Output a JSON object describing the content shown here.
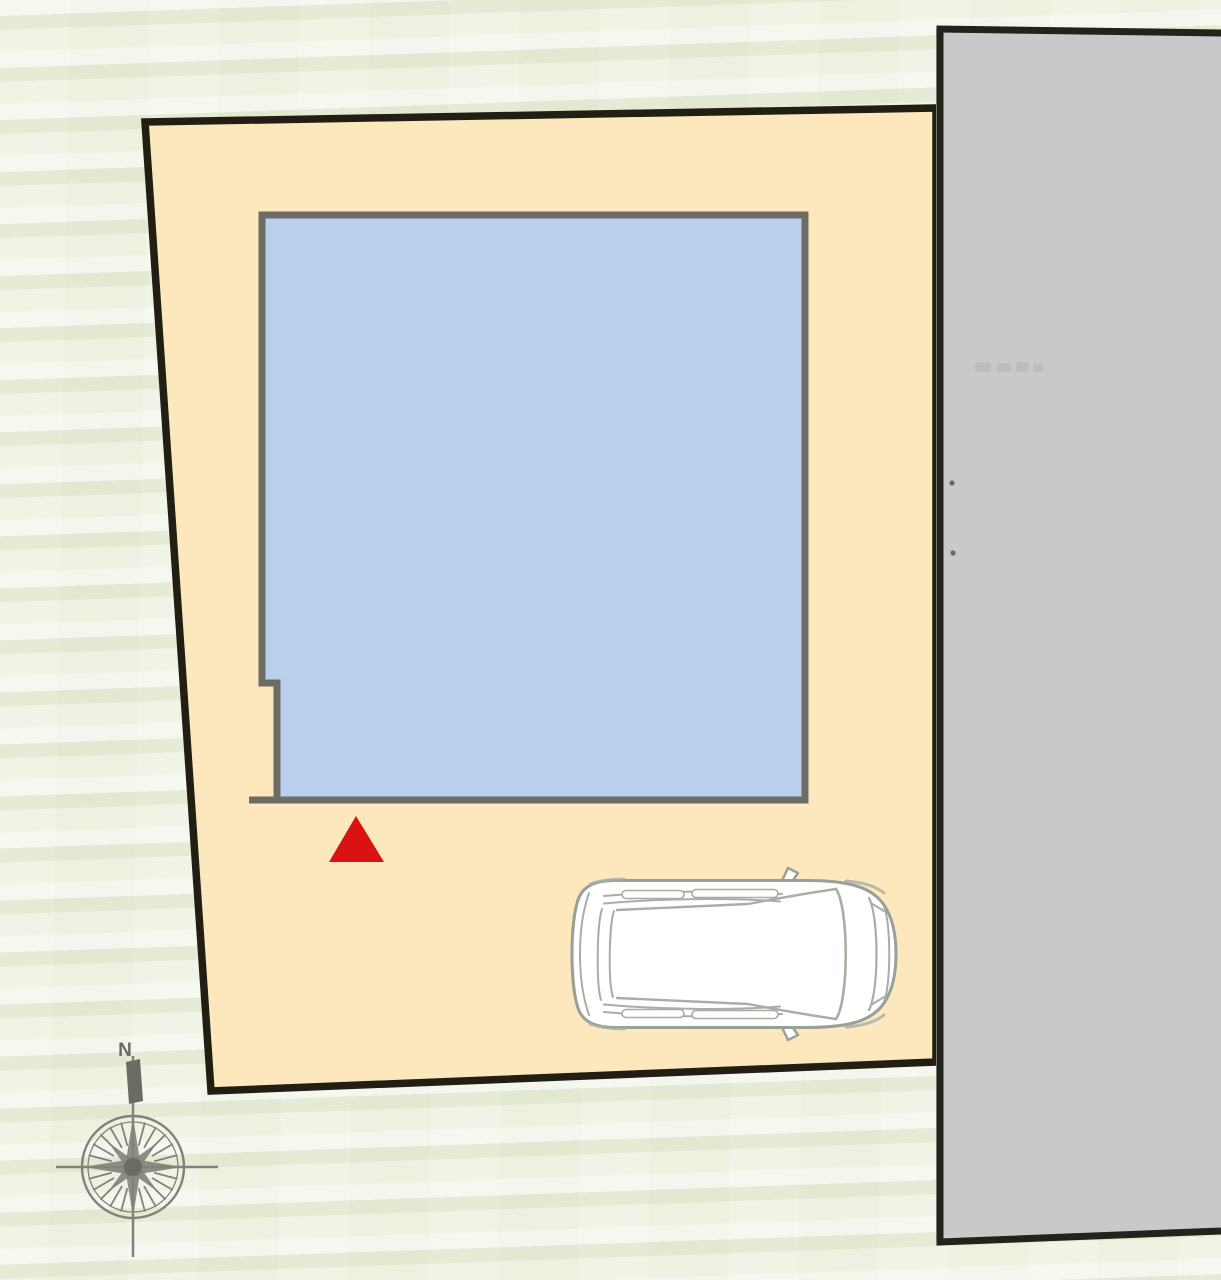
{
  "css_vars": {
    "bg": "#edf0e0"
  },
  "compass": {
    "north_label": "N"
  },
  "colors": {
    "background": "#edf0e0",
    "parcel_fill": "#fce8bc",
    "parcel_border": "#211f13",
    "building_fill": "#b9cfec",
    "building_border": "#6d6d66",
    "entrance_marker": "#da1212",
    "road_fill": "#c9c9c9",
    "road_border": "#23231b",
    "road_speck": "#6a6a62",
    "car_fill": "#ffffff",
    "car_stroke": "#99a09a",
    "car_detail": "#a8aea6",
    "compass": "#82827a",
    "compass_dark": "#6b6b63"
  }
}
